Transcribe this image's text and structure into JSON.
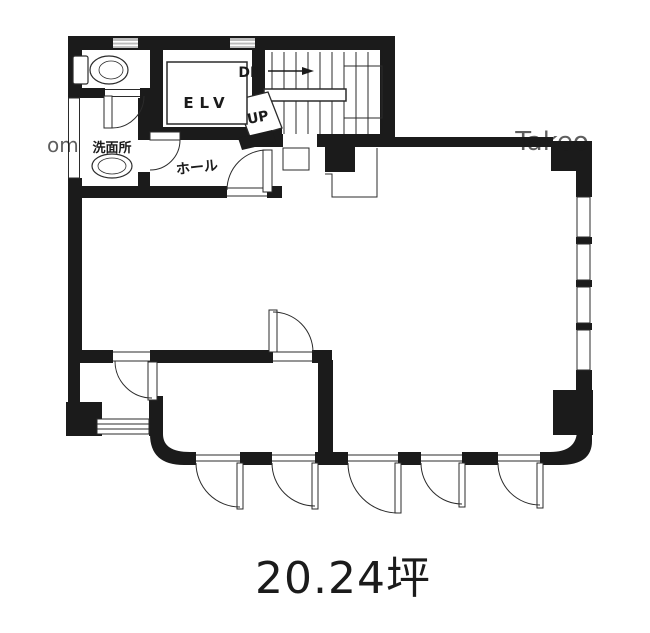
{
  "plan": {
    "area_label": "20.24坪",
    "rooms": {
      "elevator": "ELV",
      "hall": "ホール",
      "washroom": "洗面所"
    },
    "stairs": {
      "down": "DN",
      "up": "UP"
    },
    "watermark": {
      "left": "om",
      "right": "Takeo"
    },
    "colors": {
      "wall": "#1b1b1b",
      "line": "#2b2b2b",
      "vent": "#bdbdbd",
      "watermark": "#b0b0b0",
      "background": "#ffffff"
    }
  }
}
